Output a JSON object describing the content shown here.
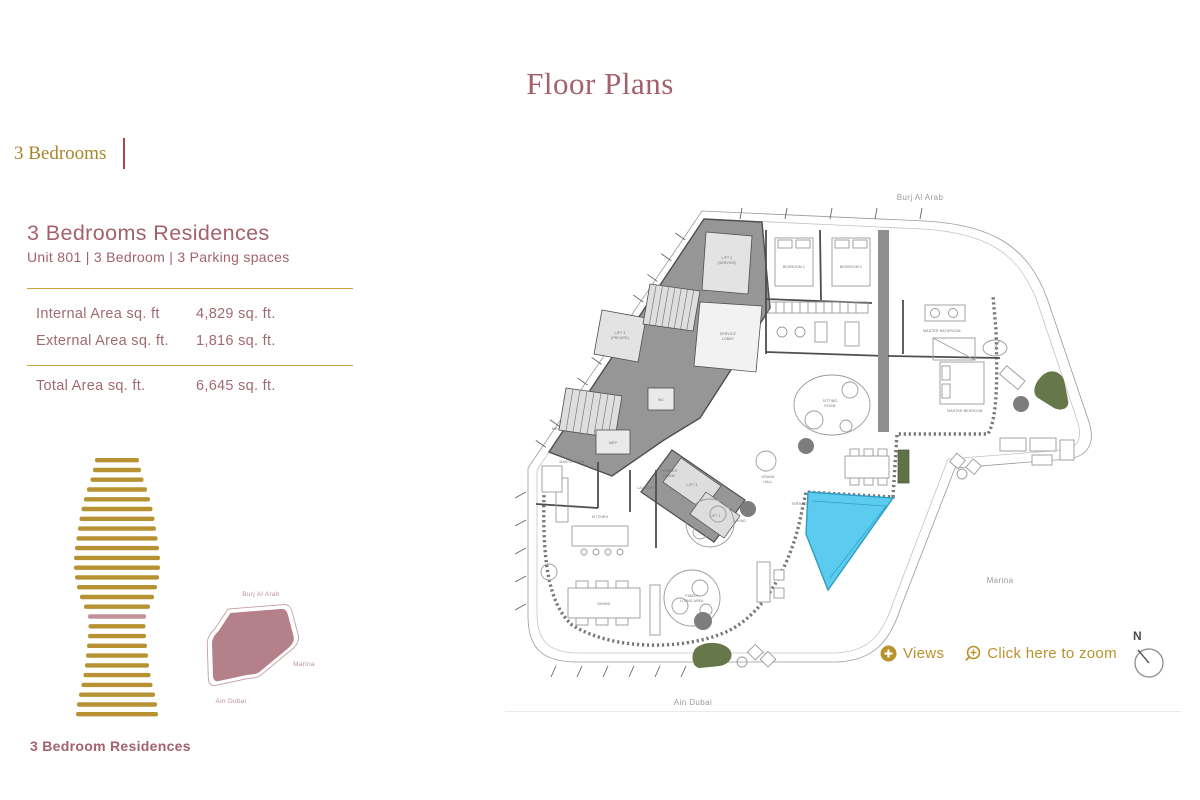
{
  "title": "Floor Plans",
  "tab": {
    "label": "3 Bedrooms"
  },
  "unit": {
    "heading": "3 Bedrooms Residences",
    "subtitle": "Unit 801 | 3 Bedroom | 3 Parking spaces",
    "areas": [
      {
        "label": "Internal Area sq. ft",
        "value": "4,829 sq. ft."
      },
      {
        "label": "External Area sq. ft.",
        "value": "1,816 sq. ft."
      }
    ],
    "total": {
      "label": "Total Area sq. ft.",
      "value": "6,645 sq. ft."
    },
    "caption": "3 Bedroom Residences"
  },
  "tower": {
    "bar_count": 27,
    "highlight_index": 16,
    "bar_color": "#b79233",
    "highlight_color": "#c2929b",
    "widths": [
      44,
      48,
      53,
      60,
      66,
      71,
      75,
      78,
      81,
      84,
      86,
      86,
      84,
      80,
      74,
      66,
      58,
      57,
      58,
      60,
      62,
      64,
      67,
      71,
      76,
      80,
      82
    ]
  },
  "minimap": {
    "burj_al_arab": "Burj Al Arab",
    "marina": "Marina",
    "ain_dubai": "Ain Dubai",
    "blob_color": "#b4808a"
  },
  "plan": {
    "landmarks": {
      "burj_al_arab": "Burj Al Arab",
      "marina": "Marina",
      "ain_dubai": "Ain Dubai"
    },
    "rooms": {
      "lift2": "LIFT 2",
      "lift2_sub": "(SERVICE)",
      "lift4": "LIFT 4",
      "lift4_sub": "(PRIVATE)",
      "service_lobby_1": "SERVICE",
      "service_lobby_2": "LOBBY",
      "lift3": "LIFT 3",
      "lift1": "LIFT 1",
      "mep": "MEP",
      "wc": "WC",
      "bedroom1": "BEDROOM 1",
      "bedroom2": "BEDROOM 2",
      "master_bathroom": "MASTER BATHROOM",
      "master_bedroom": "MASTER BEDROOM",
      "powder_1": "POWDER",
      "powder_2": "ROOM",
      "grand_hall_1": "GRAND",
      "grand_hall_2": "HALL",
      "sitting_1": "SITTING",
      "sitting_2": "ROOM",
      "living": "LIVING",
      "kitchen": "KITCHEN",
      "laundry": "LAUNDRY",
      "maids_room": "MAID'S ROOM",
      "dining": "DINING",
      "family_1": "FAMILY",
      "family_2": "LIVING AREA",
      "terrace": "TERRACE"
    },
    "controls": {
      "views": "Views",
      "zoom": "Click here to zoom",
      "compass": "N"
    },
    "pool_color": "#5bcbf0"
  },
  "colors": {
    "gold": "#b8922d",
    "gold_line": "#c7a23c",
    "mauve": "#a4616d"
  }
}
